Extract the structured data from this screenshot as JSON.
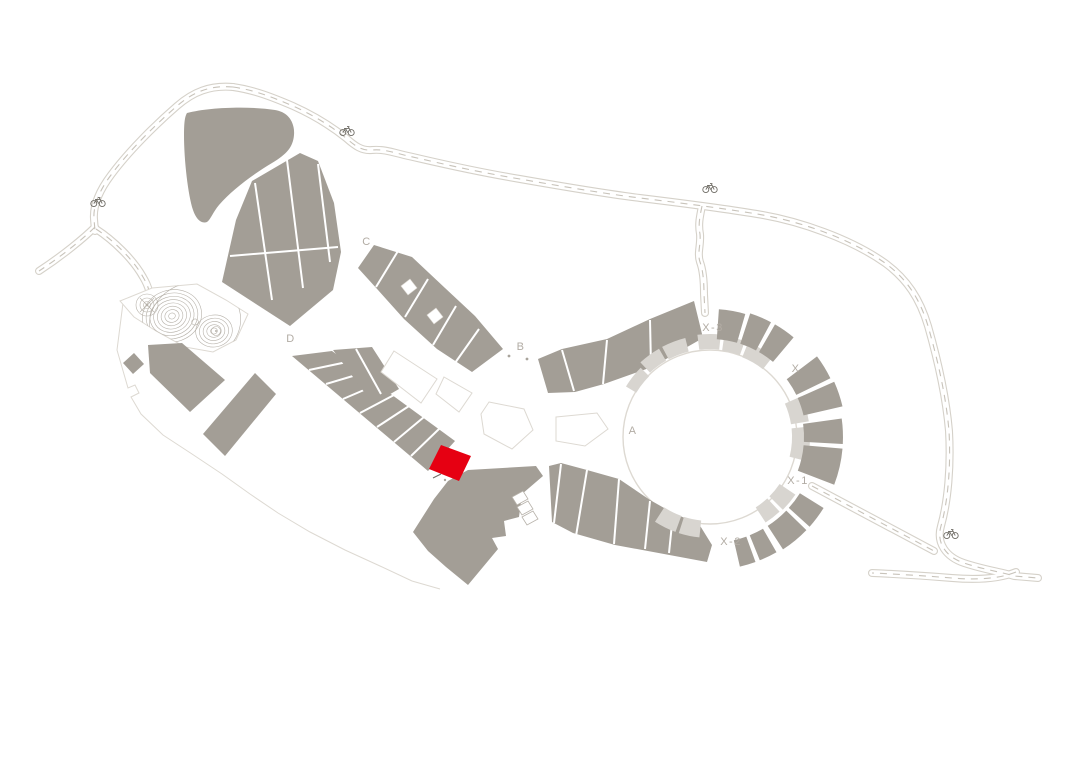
{
  "map": {
    "background": "#ffffff",
    "colors": {
      "building": "#a39e96",
      "building_light": "#d8d5d0",
      "highlight": "#e60012",
      "road_edge": "#d5d1c9",
      "road_dash": "#c8c3ba",
      "outline": "#ddd9d2",
      "contour": "#b6b1a9",
      "label": "#b2aca4",
      "icon": "#6f6c65",
      "background": "#ffffff"
    },
    "zone_labels": [
      {
        "id": "A",
        "text": "A",
        "x": 633,
        "y": 434
      },
      {
        "id": "B",
        "text": "B",
        "x": 521,
        "y": 350
      },
      {
        "id": "C",
        "text": "C",
        "x": 367,
        "y": 245
      },
      {
        "id": "D",
        "text": "D",
        "x": 291,
        "y": 342
      },
      {
        "id": "X",
        "text": "X",
        "x": 796,
        "y": 372
      },
      {
        "id": "X-1",
        "text": "X-1",
        "x": 798,
        "y": 484
      },
      {
        "id": "X-2",
        "text": "X-2",
        "x": 731,
        "y": 545
      },
      {
        "id": "X-3",
        "text": "X-3",
        "x": 713,
        "y": 331
      }
    ],
    "bike_icons": [
      {
        "x": 98,
        "y": 201
      },
      {
        "x": 347,
        "y": 130
      },
      {
        "x": 710,
        "y": 187
      },
      {
        "x": 951,
        "y": 533
      }
    ],
    "highlighted_building": {
      "color": "#e60012"
    }
  }
}
